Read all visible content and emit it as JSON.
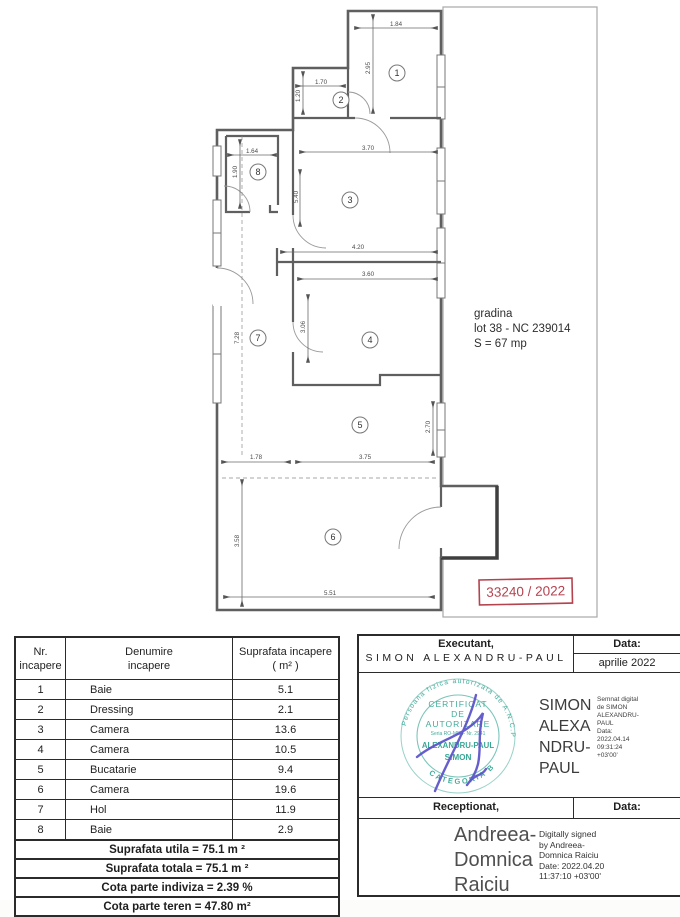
{
  "plan": {
    "garden": {
      "line1": "gradina",
      "line2": "lot 38 - NC 239014",
      "line3": "S = 67 mp"
    },
    "stamp_number": "33240 / 2022",
    "room_numbers": [
      "1",
      "2",
      "3",
      "4",
      "5",
      "6",
      "7",
      "8"
    ],
    "dims": {
      "w184": "1.84",
      "w170": "1.70",
      "w164": "1.64",
      "w370": "3.70",
      "w420": "4.20",
      "w360": "3.60",
      "w178": "1.78",
      "w375": "3.75",
      "w551": "5.51",
      "h295": "2.95",
      "h120": "1.20",
      "h190": "1.90",
      "h540": "5.40",
      "h306": "3.06",
      "h728": "7.28",
      "h270": "2.70",
      "h358": "3.58"
    }
  },
  "rooms_table": {
    "headers": {
      "c1l1": "Nr.",
      "c1l2": "incapere",
      "c2l1": "Denumire",
      "c2l2": "incapere",
      "c3l1": "Suprafata incapere",
      "c3l2": "( m² )"
    },
    "rows": [
      {
        "nr": "1",
        "name": "Baie",
        "area": "5.1"
      },
      {
        "nr": "2",
        "name": "Dressing",
        "area": "2.1"
      },
      {
        "nr": "3",
        "name": "Camera",
        "area": "13.6"
      },
      {
        "nr": "4",
        "name": "Camera",
        "area": "10.5"
      },
      {
        "nr": "5",
        "name": "Bucatarie",
        "area": "9.4"
      },
      {
        "nr": "6",
        "name": "Camera",
        "area": "19.6"
      },
      {
        "nr": "7",
        "name": "Hol",
        "area": "11.9"
      },
      {
        "nr": "8",
        "name": "Baie",
        "area": "2.9"
      }
    ],
    "summary": [
      "Suprafata utila = 75.1 m ²",
      "Suprafata totala = 75.1 m ²",
      "Cota parte indiviza = 2.39 %",
      "Cota parte teren = 47.80 m²"
    ]
  },
  "exec_panel": {
    "executant_label": "Executant,",
    "executant_name": "SIMON ALEXANDRU-PAUL",
    "data_label": "Data:",
    "data_value": "aprilie 2022",
    "receptionat_label": "Receptionat,",
    "data_label2": "Data:",
    "green_stamp": {
      "arc_top": "Persoana fizica autorizata de A.N.C.P.I.",
      "l1": "CERTIFICAT",
      "l2": "DE",
      "l3": "AUTORIZARE",
      "l4": "Seria RO-MB-F Nr. 2941",
      "l5": "ALEXANDRU-PAUL",
      "l6": "SIMON",
      "arc_bottom": "CATEGORIA B"
    },
    "sig1": {
      "name_lines": [
        "SIMON",
        "ALEXA",
        "NDRU-",
        "PAUL"
      ],
      "detail_lines": [
        "Semnat digital",
        "de SIMON",
        "ALEXANDRU-",
        "PAUL",
        "Data:",
        "2022.04.14",
        "09:31:24",
        "+03'00'"
      ]
    },
    "sig2": {
      "name_lines": [
        "Andreea-",
        "Domnica",
        "Raiciu"
      ],
      "detail_lines": [
        "Digitally signed",
        "by Andreea-",
        "Domnica Raiciu",
        "Date: 2022.04.20",
        "11:37:10 +03'00'"
      ]
    }
  },
  "colors": {
    "stamp_green": "#2aa18e",
    "stamp_red": "#b4434e",
    "signature_blue": "#5a50c9"
  }
}
